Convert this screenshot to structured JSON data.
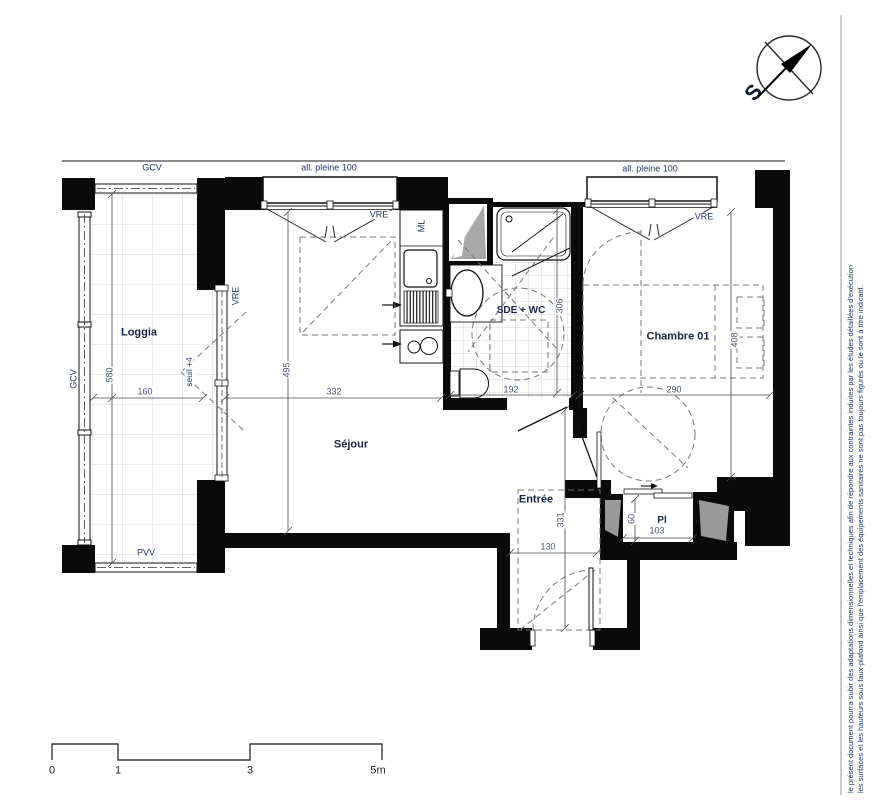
{
  "plan": {
    "rooms": {
      "loggia": "Loggia",
      "sejour": "Séjour",
      "sde": "SDE + WC",
      "chambre": "Chambre 01",
      "entree": "Entrée",
      "placard": "Pl"
    },
    "annotations": {
      "gcv": "GCV",
      "pvv": "PVV",
      "vre": "VRE",
      "ml": "ML",
      "all_pleine": "all. pleine 100",
      "seuil": "seuil +4"
    },
    "dimensions": {
      "loggia_h": "580",
      "loggia_w": "160",
      "sejour_h": "495",
      "sejour_w": "332",
      "sde_w": "192",
      "sde_h": "306",
      "chambre_w": "290",
      "chambre_h": "408",
      "entree_h": "331",
      "entree_w": "130",
      "placard_d": "60",
      "placard_w": "103"
    }
  },
  "compass": {
    "south": "S"
  },
  "scale_bar": {
    "t0": "0",
    "t1": "1",
    "t3": "3",
    "t5": "5m"
  },
  "disclaimer": {
    "line1": "le présent document pourra subir des adaptations dimensionnelles et techniques afin de répondre aux contraintes induites par les études détaillées d'exécution",
    "line2": "les surfaces et les hauteurs sous faux-plafond ainsi que l'emplacement des équipements sanitaires ne sont pas toujours figurés ou le sont à titre indicatif."
  },
  "colors": {
    "wall": "#0a0a0a",
    "room_label": "#17243f",
    "dimension": "#49566e",
    "disclaimer": "#1f3864"
  }
}
